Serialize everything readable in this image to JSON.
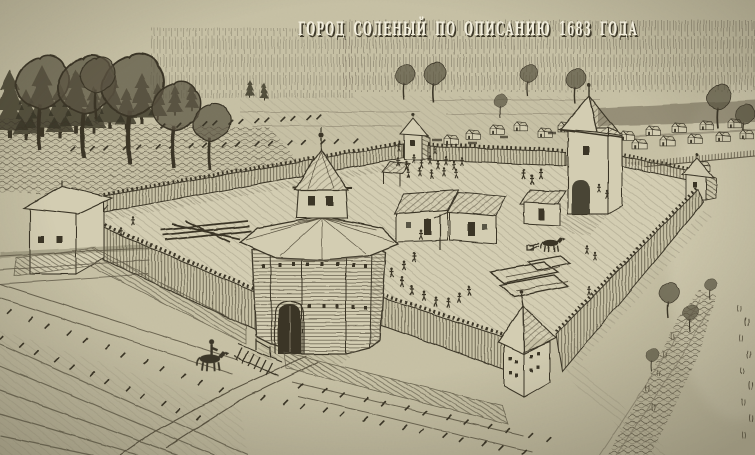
{
  "artwork": {
    "title": "ГОРОД СОЛЕНЫЙ ПО ОПИСАНИЮ 1683 ГОДА"
  },
  "colors": {
    "paper": "#c8c2a6",
    "paper_light": "#d3cdb2",
    "paper_dark": "#b3ac90",
    "ink_dark": "#3b3628",
    "ink_mid": "#5c5543",
    "ink_light": "#8d8671",
    "title_fill": "#f3efde",
    "title_shadow": "#3f3a2a"
  }
}
